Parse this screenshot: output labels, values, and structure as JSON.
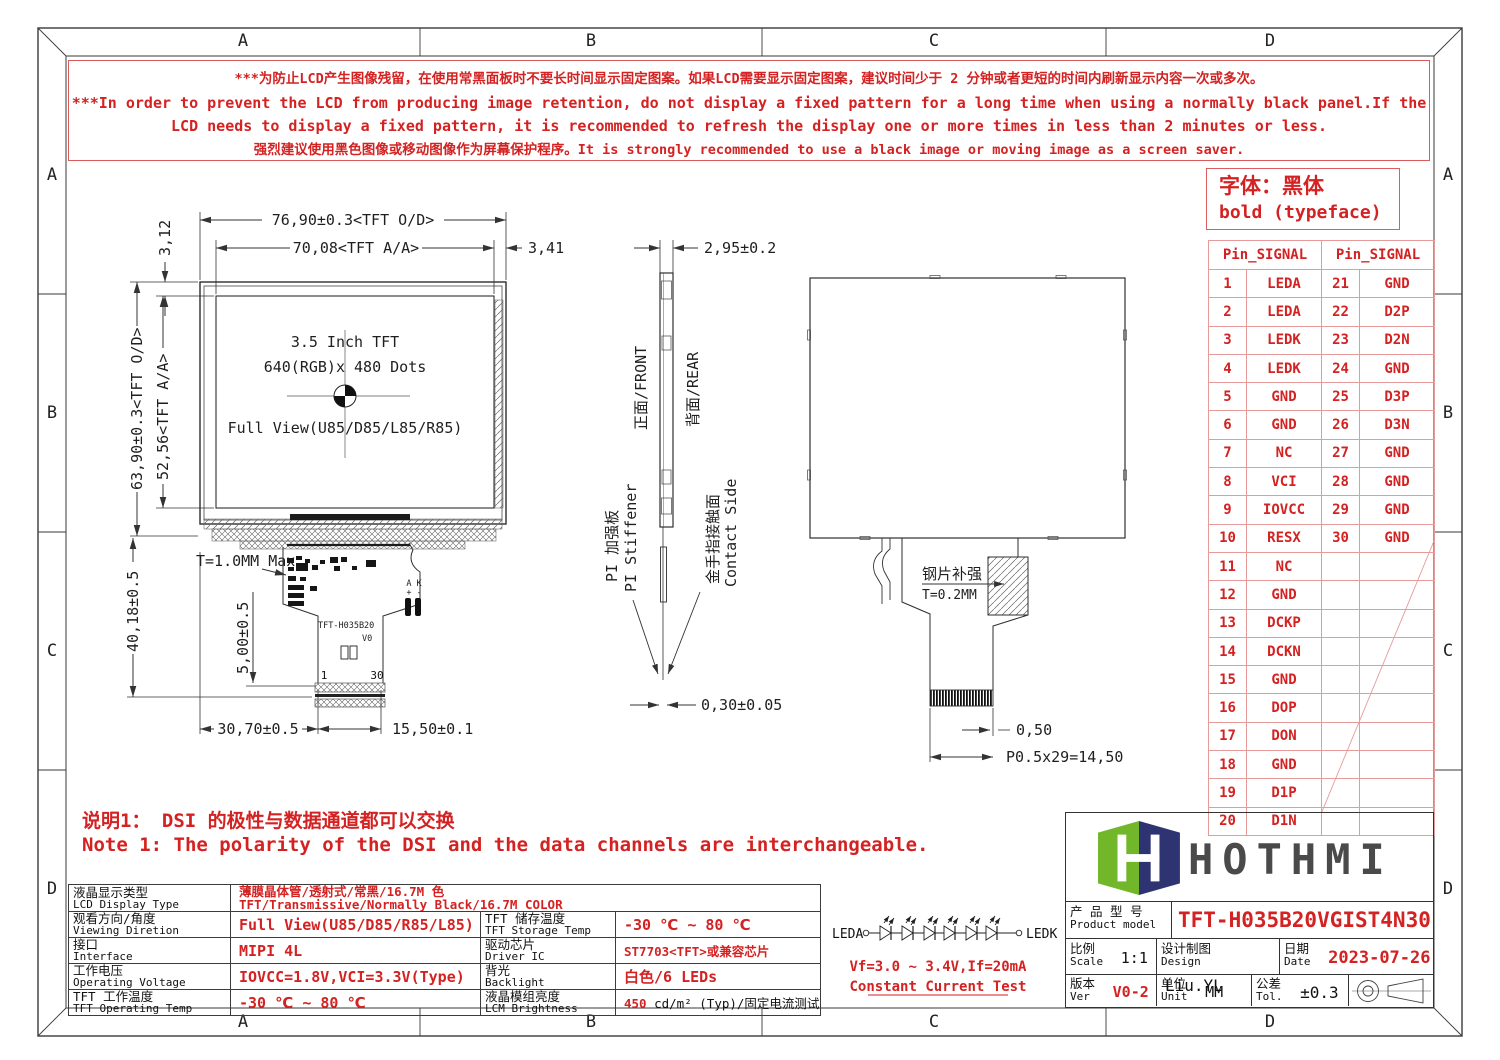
{
  "frame": {
    "top_zones": [
      "A",
      "B",
      "C",
      "D"
    ],
    "bottom_zones": [
      "A",
      "B",
      "C",
      "D"
    ],
    "left_zones": [
      "A",
      "B",
      "C",
      "D"
    ],
    "right_zones": [
      "A",
      "B",
      "C",
      "D"
    ]
  },
  "warning": {
    "lines": [
      "***为防止LCD产生图像残留，在使用常黑面板时不要长时间显示固定图案。如果LCD需要显示固定图案，建议时间少于 2 分钟或者更短的时间内刷新显示内容一次或多次。",
      "***In order to prevent the LCD from producing image retention, do not display a fixed pattern for a long time when using a normally black panel.If the",
      "LCD needs to display a fixed pattern,  it is recommended to refresh the display one or more times in less than 2 minutes or less.",
      "强烈建议使用黑色图像或移动图像作为屏幕保护程序。It is strongly recommended to use a black image or moving image as a screen saver."
    ]
  },
  "font_note": {
    "line1": "字体：黑体",
    "line2": "bold (typeface)"
  },
  "pin_table": {
    "header": "Pin_SIGNAL",
    "rows": [
      [
        "1",
        "LEDA",
        "21",
        "GND"
      ],
      [
        "2",
        "LEDA",
        "22",
        "D2P"
      ],
      [
        "3",
        "LEDK",
        "23",
        "D2N"
      ],
      [
        "4",
        "LEDK",
        "24",
        "GND"
      ],
      [
        "5",
        "GND",
        "25",
        "D3P"
      ],
      [
        "6",
        "GND",
        "26",
        "D3N"
      ],
      [
        "7",
        "NC",
        "27",
        "GND"
      ],
      [
        "8",
        "VCI",
        "28",
        "GND"
      ],
      [
        "9",
        "IOVCC",
        "29",
        "GND"
      ],
      [
        "10",
        "RESX",
        "30",
        "GND"
      ],
      [
        "11",
        "NC",
        "",
        ""
      ],
      [
        "12",
        "GND",
        "",
        ""
      ],
      [
        "13",
        "DCKP",
        "",
        ""
      ],
      [
        "14",
        "DCKN",
        "",
        ""
      ],
      [
        "15",
        "GND",
        "",
        ""
      ],
      [
        "16",
        "DOP",
        "",
        ""
      ],
      [
        "17",
        "DON",
        "",
        ""
      ],
      [
        "18",
        "GND",
        "",
        ""
      ],
      [
        "19",
        "D1P",
        "",
        ""
      ],
      [
        "20",
        "D1N",
        "",
        ""
      ]
    ]
  },
  "front_view": {
    "dim_w_od": "76,90±0.3<TFT O/D>",
    "dim_w_aa": "70,08<TFT A/A>",
    "dim_gap_right": "3,41",
    "dim_gap_top": "3,12",
    "dim_h_od": "63,90±0.3<TFT O/D>",
    "dim_h_aa": "52,56<TFT A/A>",
    "dim_fpc": "40,18±0.5",
    "dim_tail_drop": "5,00±0.5",
    "dim_tail_x": "30,70±0.5",
    "dim_tail_w": "15,50±0.1",
    "thickness": "T=1.0MM Max",
    "center_line1": "3.5 Inch TFT",
    "center_line2": "640(RGB)x 480 Dots",
    "center_line3": "Full View(U85/D85/L85/R85)",
    "fpc_model": "TFT-H035B20",
    "fpc_ver": "V0",
    "pin_first": "1",
    "pin_last": "30",
    "ak_label": "A K",
    "ak_polarity": "+ -"
  },
  "side_view": {
    "dim_thickness": "2,95±0.2",
    "front": "正面/FRONT",
    "rear": "背面/REAR",
    "pi_en": "PI Stiffener",
    "pi_cn": "PI 加强板",
    "contact_en": "Contact Side",
    "contact_cn": "金手指接触面",
    "dim_tail": "0,30±0.05"
  },
  "rear_view": {
    "stiffener_cn": "钢片补强",
    "stiffener_t": "T=0.2MM",
    "dim_pitch": "0,50",
    "dim_total": "P0.5x29=14,50"
  },
  "led": {
    "anode": "LEDA",
    "cathode": "LEDK",
    "spec": "Vf=3.0 ~ 3.4V,If=20mA",
    "test": "Constant Current Test"
  },
  "notes": {
    "cn": "说明1： DSI 的极性与数据通道都可以交换",
    "en": "Note 1: The polarity of the DSI and the data channels are interchangeable."
  },
  "spec": {
    "rows": [
      {
        "cn": "液晶显示类型",
        "en": "LCD Display Type",
        "val_cn": "薄膜晶体管/透射式/常黑/16.7M 色",
        "val_en": "TFT/Transmissive/Normally Black/16.7M COLOR"
      },
      {
        "cn": "观看方向/角度",
        "en": "Viewing Diretion",
        "val": "Full View(U85/D85/R85/L85)",
        "cn2": "TFT 储存温度",
        "en2": "TFT Storage Temp",
        "val2": "-30 ℃ ~ 80 ℃"
      },
      {
        "cn": "接口",
        "en": "Interface",
        "val": "MIPI 4L",
        "cn2": "驱动芯片",
        "en2": "Driver IC",
        "val2": "ST7703<TFT>或兼容芯片"
      },
      {
        "cn": "工作电压",
        "en": "Operating Voltage",
        "val": "IOVCC=1.8V,VCI=3.3V(Type)",
        "cn2": "背光",
        "en2": "Backlight",
        "val2": "白色/6 LEDs"
      },
      {
        "cn": "TFT 工作温度",
        "en": "TFT Operating Temp",
        "val": "-30 ℃ ~ 80 ℃",
        "cn2": "液晶模组亮度",
        "en2": "LCM Brightness",
        "val2_red": "450",
        "val2_rest": "cd/m² (Typ)/固定电流测试"
      }
    ]
  },
  "title_block": {
    "brand": "HOTHMI",
    "model_cn": "产 品 型 号",
    "model_en": "Product model",
    "model": "TFT-H035B20VGIST4N30",
    "scale_cn": "比例",
    "scale_en": "Scale",
    "scale": "1:1",
    "design_cn": "设计制图",
    "design_en": "Design",
    "design": "Liu.YL",
    "date_cn": "日期",
    "date_en": "Date",
    "date": "2023-07-26",
    "ver_cn": "版本",
    "ver_en": "Ver",
    "ver": "V0-2",
    "unit_cn": "单位",
    "unit_en": "Unit",
    "unit": "MM",
    "tol_cn": "公差",
    "tol_en": "Tol.",
    "tol": "±0.3"
  },
  "colors": {
    "red": "#d42222",
    "grid_red": "#e79a9a",
    "line": "#3a3a3a",
    "logo_green": "#72b72a",
    "logo_navy": "#2e3372",
    "logo_text": "#4a4a4a"
  }
}
